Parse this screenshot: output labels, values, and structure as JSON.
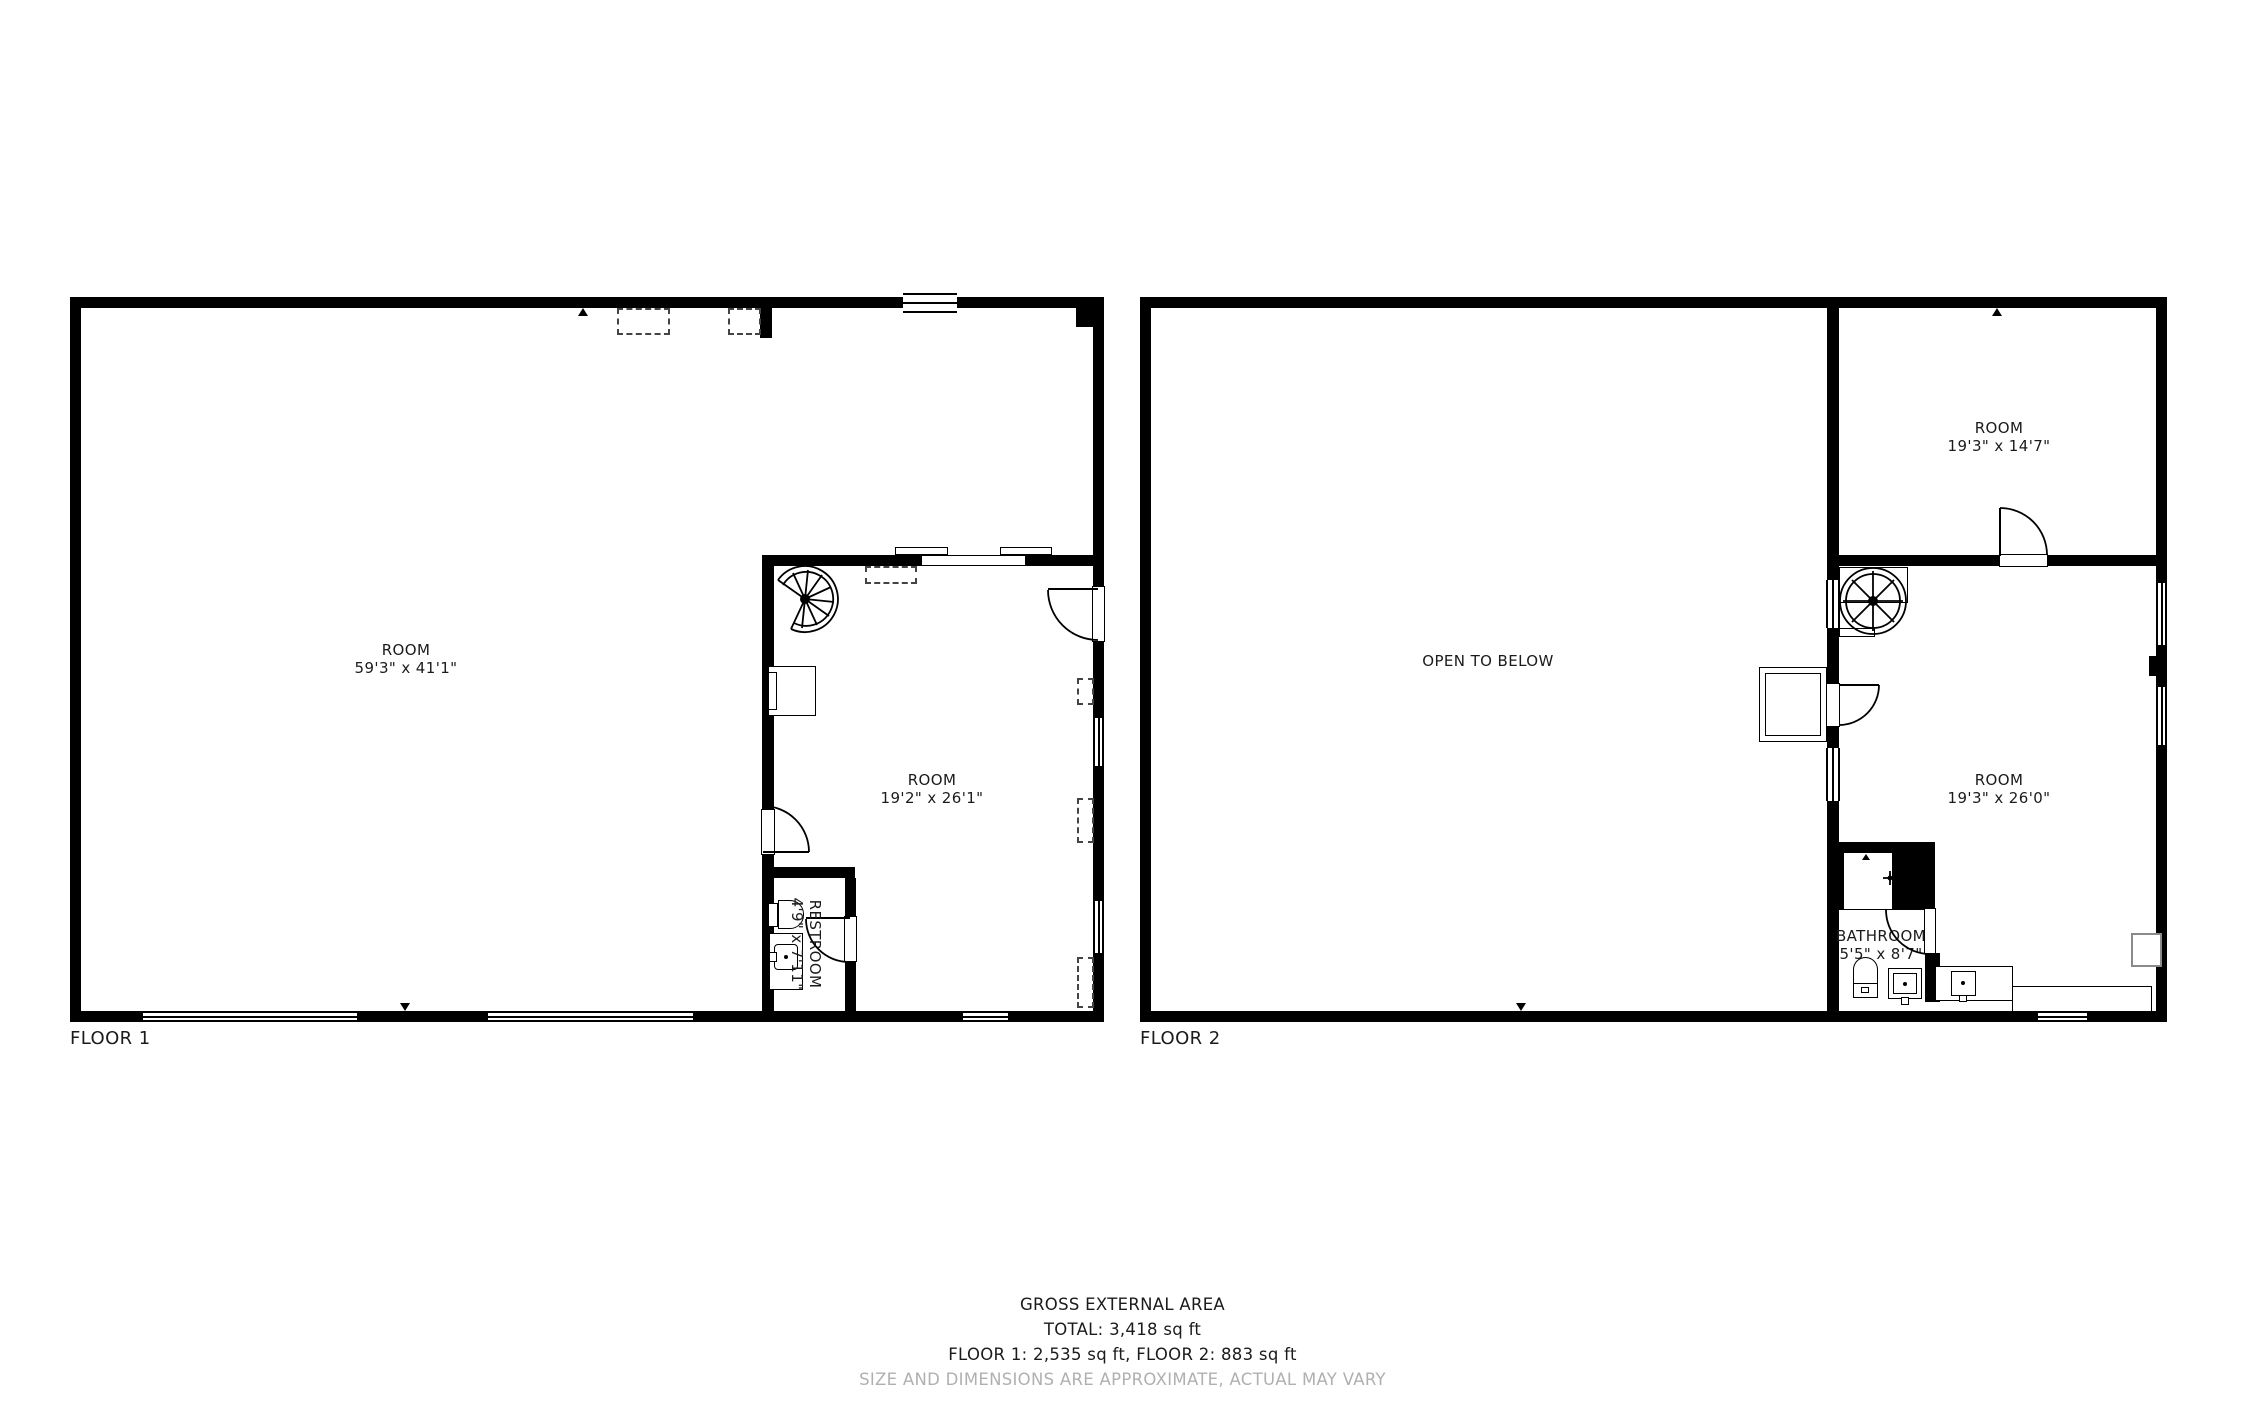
{
  "floor1": {
    "label": "FLOOR 1",
    "room_main": {
      "name": "ROOM",
      "dims": "59'3\" x 41'1\""
    },
    "room_inner": {
      "name": "ROOM",
      "dims": "19'2\" x 26'1\""
    },
    "restroom": {
      "name": "RESTROOM",
      "dims": "4'9\" x 7'11\""
    }
  },
  "floor2": {
    "label": "FLOOR 2",
    "open_label": "OPEN TO BELOW",
    "room_top": {
      "name": "ROOM",
      "dims": "19'3\" x 14'7\""
    },
    "room_bottom": {
      "name": "ROOM",
      "dims": "19'3\" x 26'0\""
    },
    "bathroom": {
      "name": "BATHROOM",
      "dims": "5'5\" x 8'7\""
    }
  },
  "footer": {
    "title": "GROSS EXTERNAL AREA",
    "total": "TOTAL: 3,418 sq ft",
    "floors": "FLOOR 1: 2,535 sq ft, FLOOR 2: 883 sq ft",
    "disclaimer": "SIZE AND DIMENSIONS ARE APPROXIMATE, ACTUAL MAY VARY"
  },
  "colors": {
    "wall": "#000000",
    "text": "#1b1b1b",
    "muted": "#b0b0b0"
  }
}
